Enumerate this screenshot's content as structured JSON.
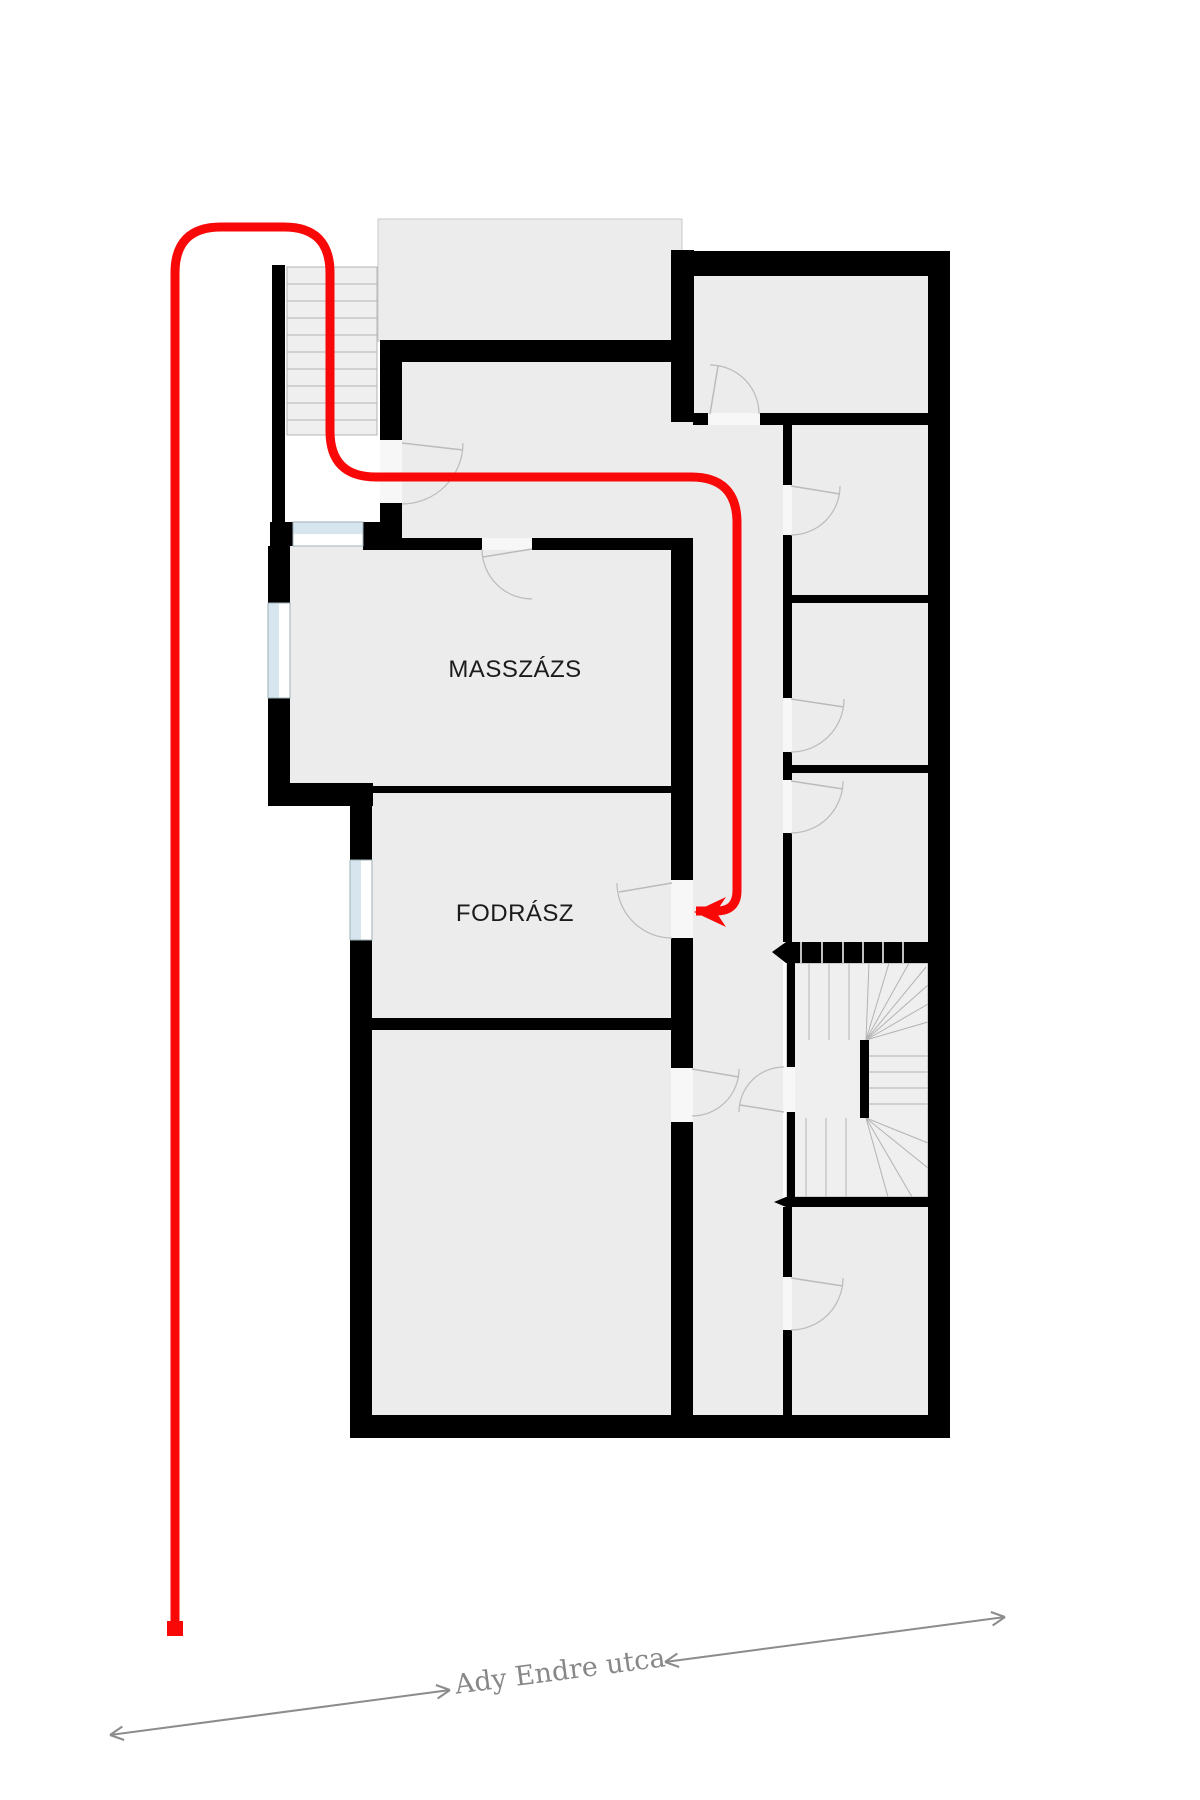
{
  "labels": {
    "masszazs": {
      "text": "MASSZÁZS"
    },
    "fodrasz": {
      "text": "FODRÁSZ"
    },
    "street": {
      "text": "Ady Endre utca"
    }
  },
  "floorplan": {
    "colors": {
      "wall": "#000000",
      "room_fill": "#ececec",
      "stair_fill": "#efefef",
      "tread": "#b3b3b3",
      "terrace_border": "#c8c8c8",
      "stair_border": "#aaaaaa",
      "window_glass": "#d7e6ee",
      "window_border": "#9db0ba",
      "door_gap": "#f7f7f7",
      "door_arc": "#bbbbbb",
      "route": "#f90808",
      "street_arrow": "#8c8c8c"
    },
    "fills": [
      {
        "r": [
          378,
          219,
          304,
          122
        ],
        "terrace": true
      },
      {
        "r": [
          402,
          362,
          270,
          176
        ]
      },
      {
        "r": [
          671,
          422,
          22,
          116
        ]
      },
      {
        "r": [
          693,
          425,
          90,
          990
        ]
      },
      {
        "r": [
          290,
          546,
          382,
          240
        ]
      },
      {
        "r": [
          372,
          793,
          300,
          227
        ]
      },
      {
        "r": [
          372,
          1030,
          300,
          385
        ]
      },
      {
        "r": [
          694,
          276,
          234,
          137
        ]
      },
      {
        "r": [
          792,
          425,
          136,
          170
        ]
      },
      {
        "r": [
          792,
          603,
          136,
          162
        ]
      },
      {
        "r": [
          792,
          773,
          136,
          169
        ]
      },
      {
        "r": [
          792,
          1207,
          136,
          208
        ]
      }
    ],
    "entrance_stairs": {
      "r": [
        287,
        267,
        90,
        168
      ],
      "tread_ys": [
        284,
        301,
        318,
        335,
        352,
        369,
        386,
        403,
        420
      ]
    },
    "main_stairs": {
      "fill": [
        787,
        963,
        141,
        234
      ],
      "treads": [
        [
          809,
          963,
          809,
          1040
        ],
        [
          829,
          963,
          829,
          1040
        ],
        [
          849,
          963,
          849,
          1040
        ],
        [
          866,
          1040,
          869,
          963
        ],
        [
          866,
          1040,
          889,
          963
        ],
        [
          866,
          1040,
          909,
          963
        ],
        [
          866,
          1040,
          926,
          967
        ],
        [
          866,
          1040,
          928,
          985
        ],
        [
          866,
          1040,
          928,
          1004
        ],
        [
          866,
          1040,
          928,
          1022
        ],
        [
          868,
          1056,
          928,
          1056
        ],
        [
          868,
          1072,
          928,
          1072
        ],
        [
          868,
          1088,
          928,
          1088
        ],
        [
          868,
          1104,
          928,
          1104
        ],
        [
          806,
          1118,
          806,
          1197
        ],
        [
          826,
          1118,
          826,
          1197
        ],
        [
          846,
          1118,
          846,
          1197
        ],
        [
          866,
          1118,
          928,
          1143
        ],
        [
          866,
          1118,
          928,
          1168
        ],
        [
          866,
          1118,
          912,
          1197
        ],
        [
          866,
          1118,
          888,
          1197
        ]
      ],
      "band_top": {
        "r": [
          786,
          942,
          149,
          21
        ],
        "divider_xs": [
          801,
          822,
          843,
          863,
          883,
          903
        ]
      },
      "band_bottom": {
        "r": [
          786,
          1197,
          149,
          10
        ],
        "divider_xs": []
      },
      "tips": [
        [
          [
            786,
            942
          ],
          [
            772,
            952
          ],
          [
            786,
            963
          ]
        ],
        [
          [
            786,
            1197
          ],
          [
            774,
            1202
          ],
          [
            786,
            1207
          ]
        ]
      ]
    },
    "walls": [
      [
        272,
        265,
        13,
        257
      ],
      [
        270,
        522,
        132,
        24
      ],
      [
        268,
        546,
        22,
        57
      ],
      [
        268,
        698,
        22,
        108
      ],
      [
        268,
        783,
        105,
        23
      ],
      [
        373,
        786,
        320,
        7
      ],
      [
        350,
        783,
        22,
        77
      ],
      [
        350,
        940,
        22,
        475
      ],
      [
        352,
        1018,
        331,
        12
      ],
      [
        350,
        1415,
        600,
        23
      ],
      [
        380,
        340,
        22,
        100
      ],
      [
        380,
        503,
        22,
        43
      ],
      [
        380,
        340,
        303,
        22
      ],
      [
        671,
        250,
        23,
        172
      ],
      [
        671,
        538,
        22,
        342
      ],
      [
        671,
        938,
        22,
        130
      ],
      [
        671,
        1122,
        22,
        293
      ],
      [
        671,
        251,
        279,
        25
      ],
      [
        928,
        251,
        22,
        1187
      ],
      [
        693,
        413,
        15,
        12
      ],
      [
        760,
        413,
        168,
        12
      ],
      [
        363,
        538,
        119,
        12
      ],
      [
        532,
        538,
        161,
        12
      ],
      [
        783,
        413,
        9,
        72
      ],
      [
        783,
        535,
        9,
        163
      ],
      [
        783,
        752,
        9,
        28
      ],
      [
        783,
        833,
        9,
        109
      ],
      [
        783,
        1207,
        9,
        70
      ],
      [
        783,
        1330,
        9,
        85
      ],
      [
        787,
        963,
        8,
        104
      ],
      [
        787,
        1112,
        8,
        85
      ],
      [
        783,
        595,
        167,
        8
      ],
      [
        783,
        765,
        167,
        8
      ],
      [
        860,
        1040,
        9,
        78
      ]
    ],
    "windows": [
      {
        "r": [
          293,
          522,
          70,
          24
        ],
        "dir": "h"
      },
      {
        "r": [
          268,
          603,
          22,
          95
        ],
        "dir": "v"
      },
      {
        "r": [
          350,
          860,
          22,
          80
        ],
        "dir": "v"
      }
    ],
    "door_gaps": [
      [
        482,
        538,
        50,
        12
      ],
      [
        380,
        440,
        22,
        63
      ],
      [
        708,
        413,
        52,
        12
      ],
      [
        783,
        485,
        9,
        50
      ],
      [
        783,
        698,
        9,
        54
      ],
      [
        783,
        780,
        9,
        53
      ],
      [
        783,
        1277,
        9,
        53
      ],
      [
        783,
        1067,
        12,
        45
      ],
      [
        671,
        880,
        22,
        58
      ],
      [
        671,
        1068,
        22,
        54
      ]
    ],
    "door_arcs": [
      {
        "c": [
          402,
          443
        ],
        "rr": 61,
        "s": [
          463,
          443
        ],
        "e": [
          402,
          504
        ],
        "sw": 1,
        "leaf": [
          463,
          450
        ]
      },
      {
        "c": [
          532,
          549
        ],
        "rr": 50,
        "s": [
          482,
          549
        ],
        "e": [
          532,
          599
        ],
        "sw": 0,
        "leaf": [
          483,
          557
        ]
      },
      {
        "c": [
          710,
          414
        ],
        "rr": 49,
        "s": [
          759,
          414
        ],
        "e": [
          710,
          365
        ],
        "sw": 0,
        "leaf": [
          718,
          366
        ]
      },
      {
        "c": [
          791,
          486
        ],
        "rr": 49,
        "s": [
          840,
          486
        ],
        "e": [
          791,
          535
        ],
        "sw": 1,
        "leaf": [
          840,
          494
        ]
      },
      {
        "c": [
          791,
          699
        ],
        "rr": 53,
        "s": [
          844,
          699
        ],
        "e": [
          791,
          752
        ],
        "sw": 1,
        "leaf": [
          844,
          707
        ]
      },
      {
        "c": [
          791,
          781
        ],
        "rr": 52,
        "s": [
          843,
          781
        ],
        "e": [
          791,
          833
        ],
        "sw": 1,
        "leaf": [
          843,
          789
        ]
      },
      {
        "c": [
          791,
          1278
        ],
        "rr": 52,
        "s": [
          843,
          1278
        ],
        "e": [
          791,
          1330
        ],
        "sw": 1,
        "leaf": [
          843,
          1286
        ]
      },
      {
        "c": [
          784,
          1112
        ],
        "rr": 45,
        "s": [
          739,
          1112
        ],
        "e": [
          784,
          1067
        ],
        "sw": 1,
        "leaf": [
          740,
          1105
        ]
      },
      {
        "c": [
          692,
          1069
        ],
        "rr": 47,
        "s": [
          739,
          1069
        ],
        "e": [
          692,
          1116
        ],
        "sw": 1,
        "leaf": [
          739,
          1077
        ]
      },
      {
        "c": [
          672,
          883
        ],
        "rr": 55,
        "s": [
          617,
          883
        ],
        "e": [
          672,
          938
        ],
        "sw": 0,
        "leaf": [
          619,
          892
        ]
      }
    ],
    "route": {
      "points": [
        [
          175,
          1622
        ],
        [
          175,
          227
        ],
        [
          330,
          227
        ],
        [
          330,
          477
        ],
        [
          737,
          477
        ],
        [
          737,
          911
        ],
        [
          696,
          911
        ]
      ],
      "corner_radius": 46,
      "stroke_width": 9,
      "start_square": [
        167,
        1621,
        16,
        15
      ],
      "arrow_head": [
        [
          694,
          912
        ],
        [
          726,
          897
        ],
        [
          716,
          912
        ],
        [
          726,
          927
        ]
      ]
    },
    "street": {
      "segments": [
        [
          110,
          1735,
          450,
          1690
        ],
        [
          665,
          1662,
          1005,
          1617
        ]
      ],
      "label_pos": [
        560,
        1680
      ],
      "label_rotation": -7.5
    }
  }
}
